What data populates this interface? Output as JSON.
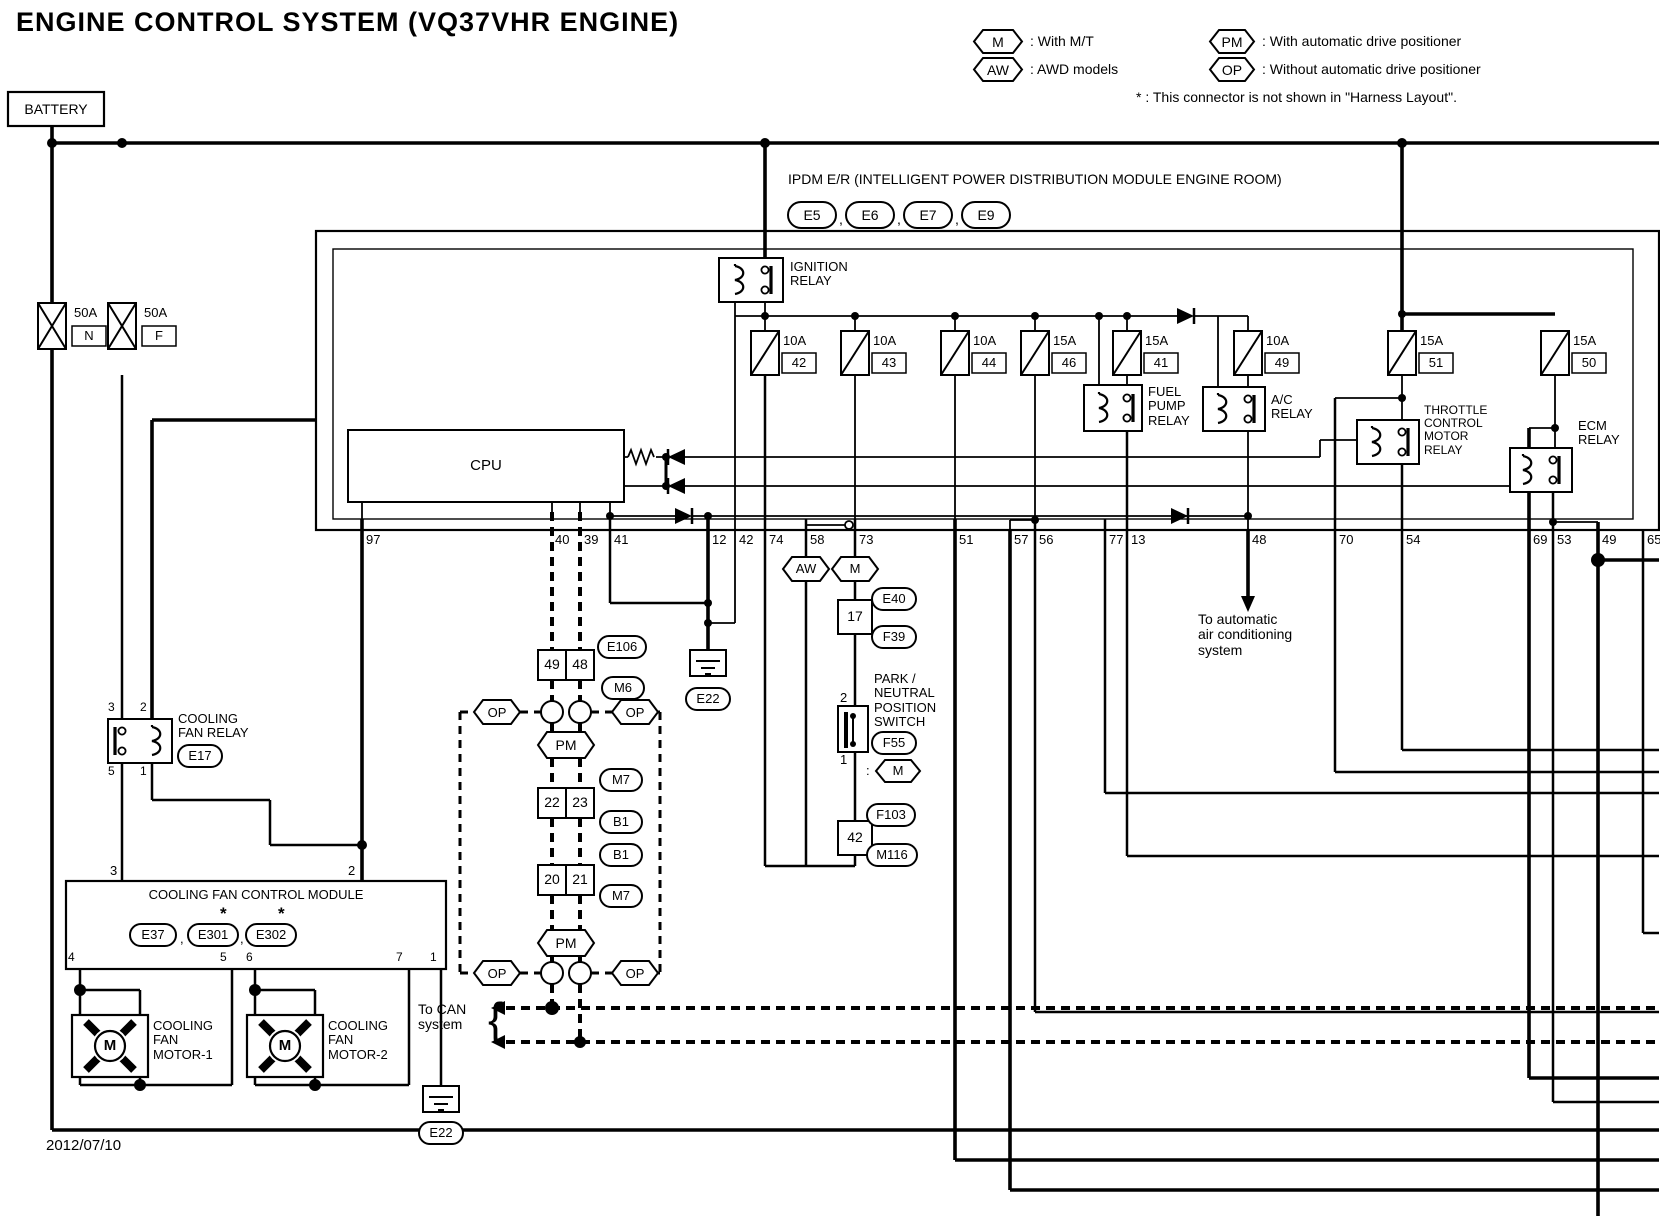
{
  "title": "ENGINE CONTROL SYSTEM (VQ37VHR ENGINE)",
  "legend": {
    "m": {
      "symbol": "M",
      "text": ": With M/T"
    },
    "aw": {
      "symbol": "AW",
      "text": ": AWD models"
    },
    "pm": {
      "symbol": "PM",
      "text": ": With automatic drive positioner"
    },
    "op": {
      "symbol": "OP",
      "text": ": Without automatic drive positioner"
    },
    "star_note": "* : This connector is not shown in \"Harness Layout\"."
  },
  "battery": {
    "label": "BATTERY"
  },
  "fusible_links": {
    "n": {
      "amp": "50A",
      "id": "N"
    },
    "f": {
      "amp": "50A",
      "id": "F"
    }
  },
  "ipdm": {
    "title": "IPDM E/R (INTELLIGENT POWER DISTRIBUTION MODULE ENGINE ROOM)",
    "sep": ",",
    "connectors": [
      "E5",
      "E6",
      "E7",
      "E9"
    ],
    "ignition_relay": "IGNITION\nRELAY",
    "cpu": "CPU",
    "fuses": [
      {
        "amp": "10A",
        "id": "42"
      },
      {
        "amp": "10A",
        "id": "43"
      },
      {
        "amp": "10A",
        "id": "44"
      },
      {
        "amp": "15A",
        "id": "46"
      },
      {
        "amp": "15A",
        "id": "41"
      },
      {
        "amp": "10A",
        "id": "49"
      },
      {
        "amp": "15A",
        "id": "51"
      },
      {
        "amp": "15A",
        "id": "50"
      }
    ],
    "relays": {
      "fuel_pump": "FUEL\nPUMP\nRELAY",
      "ac": "A/C\nRELAY",
      "throttle": "THROTTLE\nCONTROL\nMOTOR\nRELAY",
      "ecm": "ECM\nRELAY"
    },
    "pins": [
      "97",
      "40",
      "39",
      "41",
      "12",
      "42",
      "74",
      "58",
      "73",
      "51",
      "57",
      "56",
      "77",
      "13",
      "48",
      "70",
      "54",
      "69",
      "53",
      "49",
      "65"
    ]
  },
  "notes": {
    "ac_system": "To automatic\nair conditioning\nsystem",
    "can_system": "To CAN\nsystem",
    "can_brace": "{"
  },
  "can_chain": {
    "e106": "E106",
    "m6": "M6",
    "m7_upper": "M7",
    "b1_upper": "B1",
    "b1_lower": "B1",
    "m7_lower": "M7",
    "op": "OP",
    "pm": "PM",
    "pair1": {
      "l": "49",
      "r": "48"
    },
    "pair2": {
      "l": "22",
      "r": "23"
    },
    "pair3": {
      "l": "20",
      "r": "21"
    }
  },
  "mt_branch": {
    "aw": "AW",
    "m": "M",
    "box17": "17",
    "e40": "E40",
    "f39": "F39",
    "pn_pin2": "2",
    "pn_pin1": "1",
    "pn_label": "PARK /\nNEUTRAL\nPOSITION\nSWITCH",
    "f55": "F55",
    "colon": ":",
    "m_opt": "M",
    "box42": "42",
    "f103": "F103",
    "m116": "M116"
  },
  "cooling": {
    "relay": {
      "label": "COOLING\nFAN RELAY",
      "connector": "E17",
      "pin_t1": "3",
      "pin_t2": "2",
      "pin_b1": "5",
      "pin_b2": "1"
    },
    "module": {
      "title": "COOLING FAN CONTROL MODULE",
      "connectors": [
        "E37",
        "E301",
        "E302"
      ],
      "sep": ",",
      "star": "*",
      "pin_t1": "3",
      "pin_t2": "2",
      "pins_bottom": [
        "4",
        "5",
        "6",
        "7",
        "1"
      ]
    },
    "motor1": {
      "symbol": "M",
      "label": "COOLING\nFAN\nMOTOR-1"
    },
    "motor2": {
      "symbol": "M",
      "label": "COOLING\nFAN\nMOTOR-2"
    }
  },
  "grounds": {
    "mid": "E22",
    "bottom": "E22"
  },
  "date": "2012/07/10"
}
